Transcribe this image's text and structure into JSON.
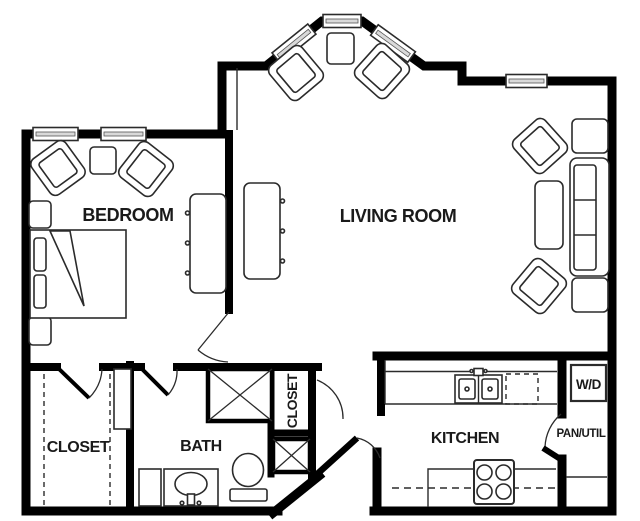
{
  "rooms": {
    "bedroom": {
      "label": "BEDROOM"
    },
    "living_room": {
      "label": "LIVING ROOM"
    },
    "closet": {
      "label": "CLOSET"
    },
    "bath": {
      "label": "BATH"
    },
    "hall_closet": {
      "label": "CLOSET"
    },
    "kitchen": {
      "label": "KITCHEN"
    },
    "washer_dryer": {
      "label": "W/D"
    },
    "pantry_utility": {
      "label": "PAN/UTIL"
    }
  },
  "colors": {
    "wall": "#000000",
    "furniture_line": "#2b2b2b",
    "background": "#ffffff",
    "label": "#1a1a1a"
  }
}
